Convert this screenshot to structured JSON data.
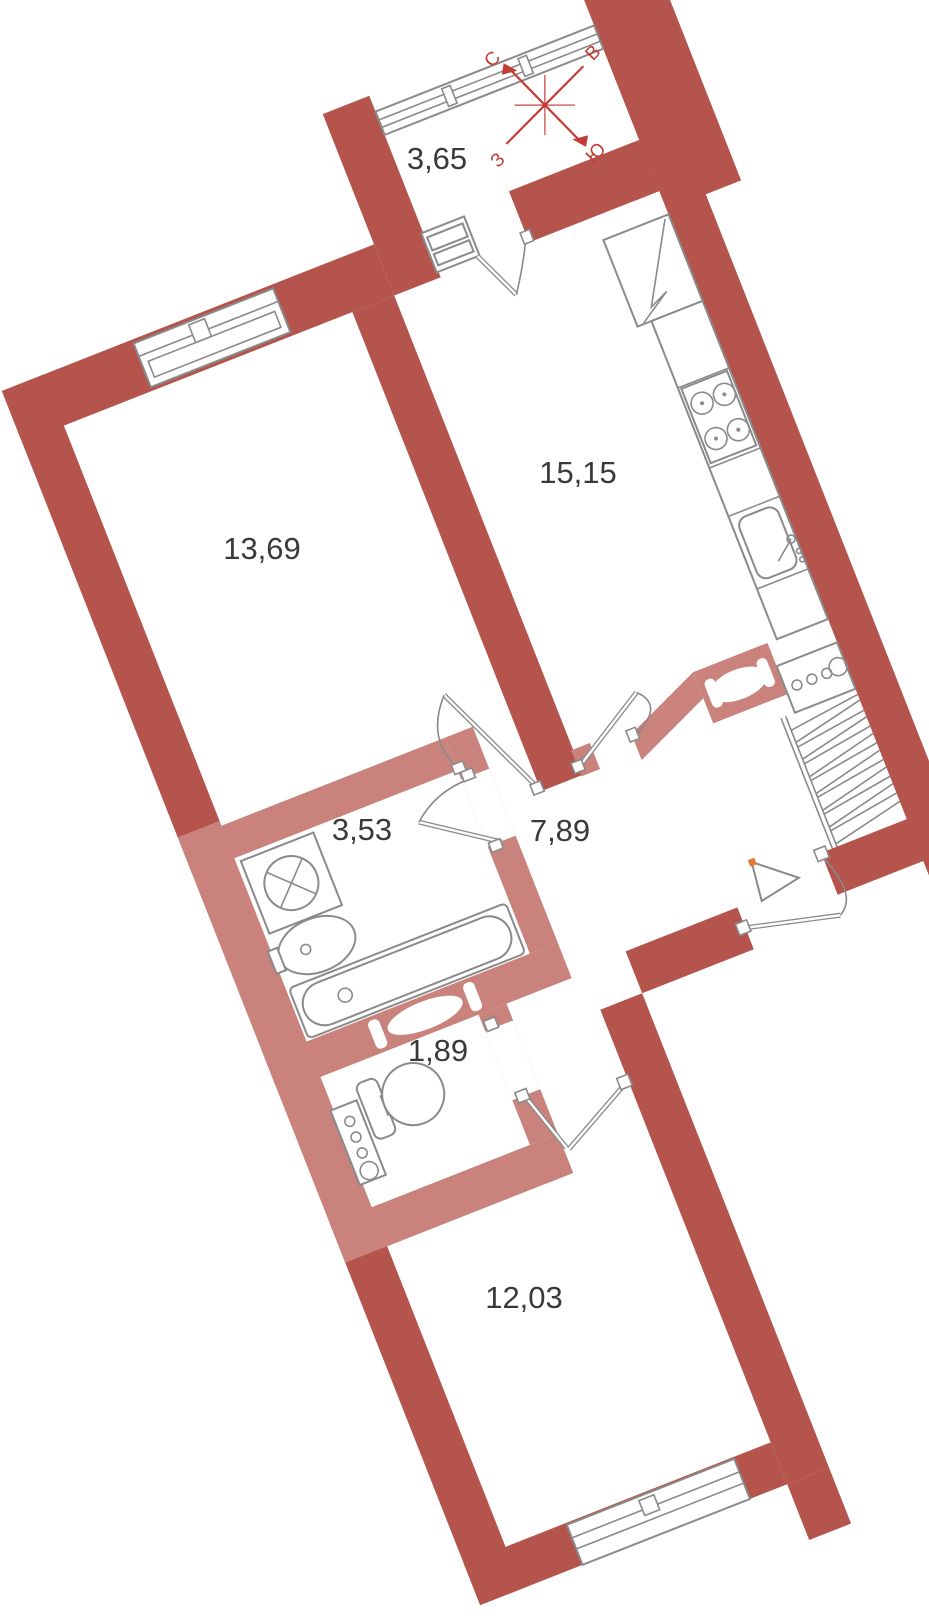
{
  "plan": {
    "rooms": {
      "balcony": {
        "area": "3,65"
      },
      "kitchen": {
        "area": "15,15"
      },
      "living_room": {
        "area": "13,69"
      },
      "bathroom": {
        "area": "3,53"
      },
      "hallway": {
        "area": "7,89"
      },
      "wc": {
        "area": "1,89"
      },
      "bedroom": {
        "area": "12,03"
      }
    },
    "compass": {
      "north": "С",
      "east": "В",
      "south": "Ю",
      "west": "З"
    },
    "colors": {
      "wall_primary": "#b4544c",
      "wall_secondary": "#c9837c",
      "fixture_outline": "#8a8a8a",
      "label_text": "#3a3a3a",
      "compass": "#c33d38",
      "entrance_marker_accent": "#e07b39"
    }
  }
}
